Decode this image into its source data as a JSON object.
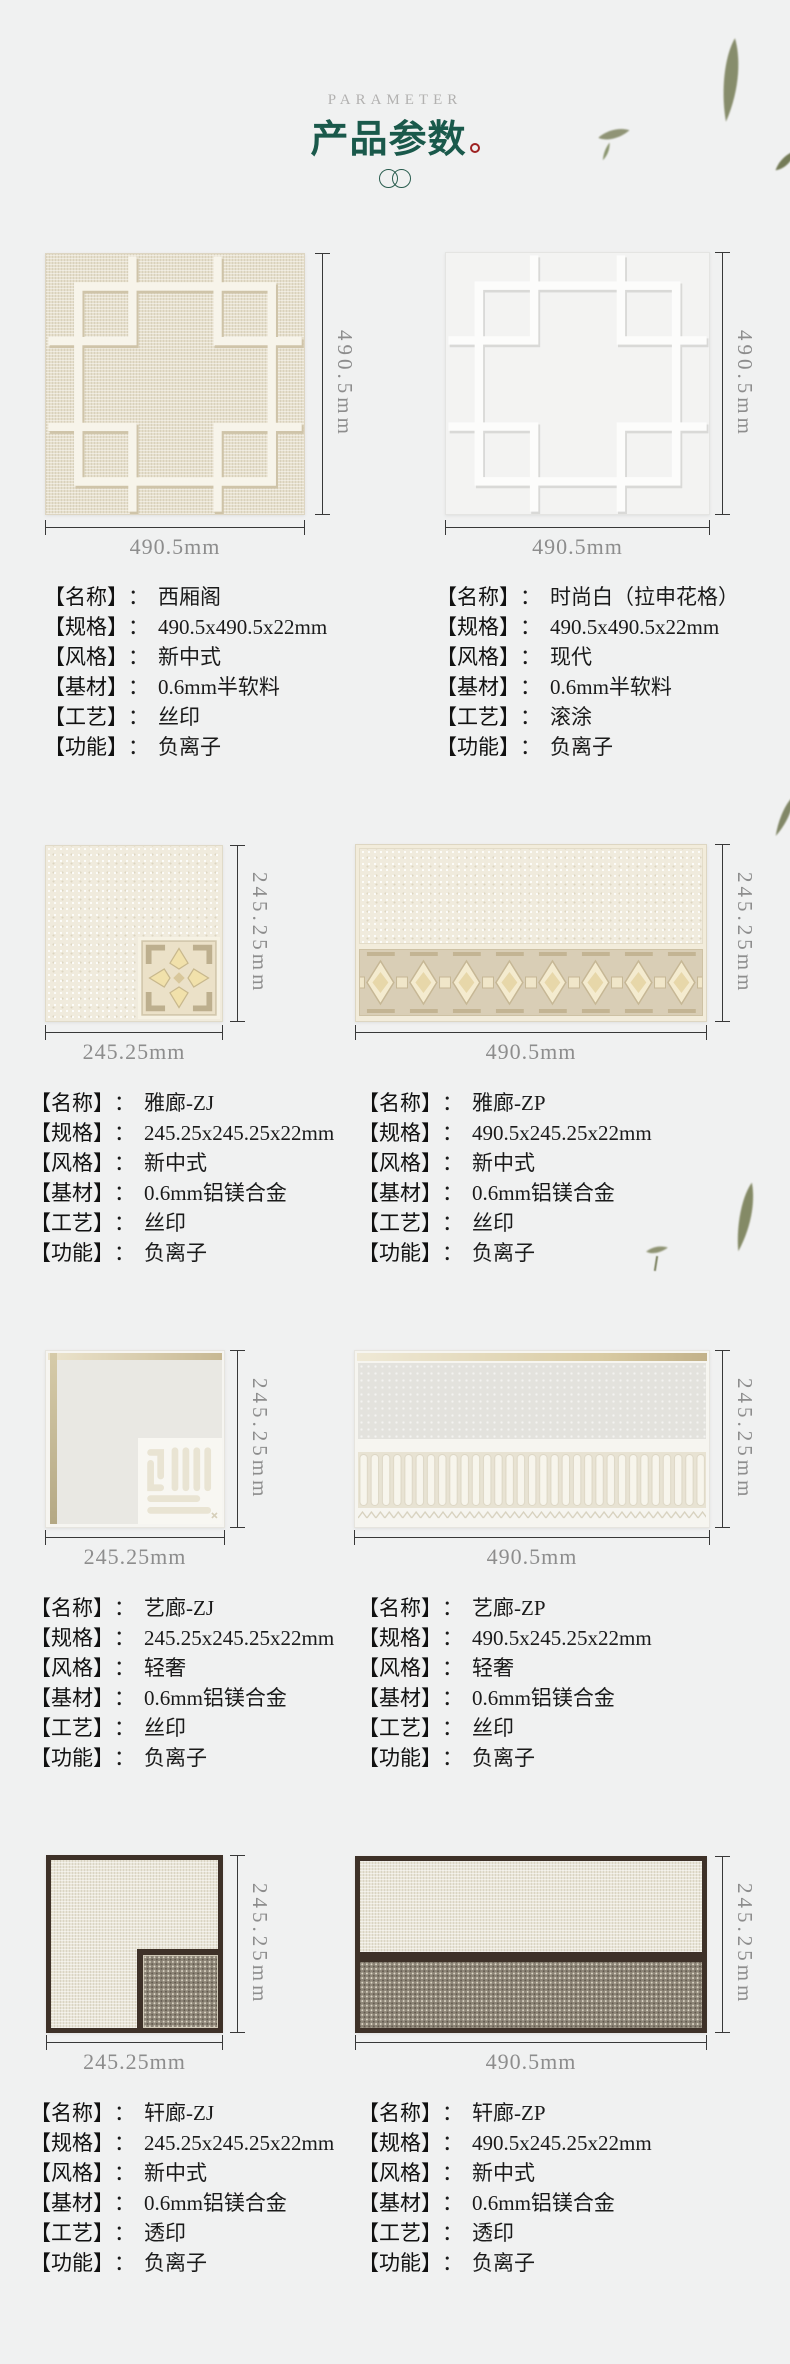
{
  "header": {
    "eyebrow": "PARAMETER",
    "title": "产品参数"
  },
  "labels": {
    "name": "【名称】",
    "spec": "【规格】",
    "style": "【风格】",
    "material": "【基材】",
    "craft": "【工艺】",
    "function": "【功能】",
    "colon": "："
  },
  "products": [
    {
      "name": "西厢阁",
      "spec": "490.5x490.5x22mm",
      "style": "新中式",
      "material": "0.6mm半软料",
      "craft": "丝印",
      "function": "负离子",
      "width_label": "490.5mm",
      "height_label": "490.5mm"
    },
    {
      "name": "时尚白（拉申花格）",
      "spec": "490.5x490.5x22mm",
      "style": "现代",
      "material": "0.6mm半软料",
      "craft": "滚涂",
      "function": "负离子",
      "width_label": "490.5mm",
      "height_label": "490.5mm"
    },
    {
      "name": "雅廊-ZJ",
      "spec": "245.25x245.25x22mm",
      "style": "新中式",
      "material": "0.6mm铝镁合金",
      "craft": "丝印",
      "function": "负离子",
      "width_label": "245.25mm",
      "height_label": "245.25mm"
    },
    {
      "name": "雅廊-ZP",
      "spec": "490.5x245.25x22mm",
      "style": "新中式",
      "material": "0.6mm铝镁合金",
      "craft": "丝印",
      "function": "负离子",
      "width_label": "490.5mm",
      "height_label": "245.25mm"
    },
    {
      "name": "艺廊-ZJ",
      "spec": "245.25x245.25x22mm",
      "style": "轻奢",
      "material": "0.6mm铝镁合金",
      "craft": "丝印",
      "function": "负离子",
      "width_label": "245.25mm",
      "height_label": "245.25mm"
    },
    {
      "name": "艺廊-ZP",
      "spec": "490.5x245.25x22mm",
      "style": "轻奢",
      "material": "0.6mm铝镁合金",
      "craft": "丝印",
      "function": "负离子",
      "width_label": "490.5mm",
      "height_label": "245.25mm"
    },
    {
      "name": "轩廊-ZJ",
      "spec": "245.25x245.25x22mm",
      "style": "新中式",
      "material": "0.6mm铝镁合金",
      "craft": "透印",
      "function": "负离子",
      "width_label": "245.25mm",
      "height_label": "245.25mm"
    },
    {
      "name": "轩廊-ZP",
      "spec": "490.5x245.25x22mm",
      "style": "新中式",
      "material": "0.6mm铝镁合金",
      "craft": "透印",
      "function": "负离子",
      "width_label": "490.5mm",
      "height_label": "245.25mm"
    }
  ],
  "colors": {
    "title_green": "#1a594b",
    "accent_red": "#9e2222",
    "dim_line": "#383838",
    "dim_label": "#8d8d8d",
    "page_bg": "#f0f1f1",
    "dark_wood": "#3e3128",
    "beige_panel": "#e6dfcc"
  }
}
